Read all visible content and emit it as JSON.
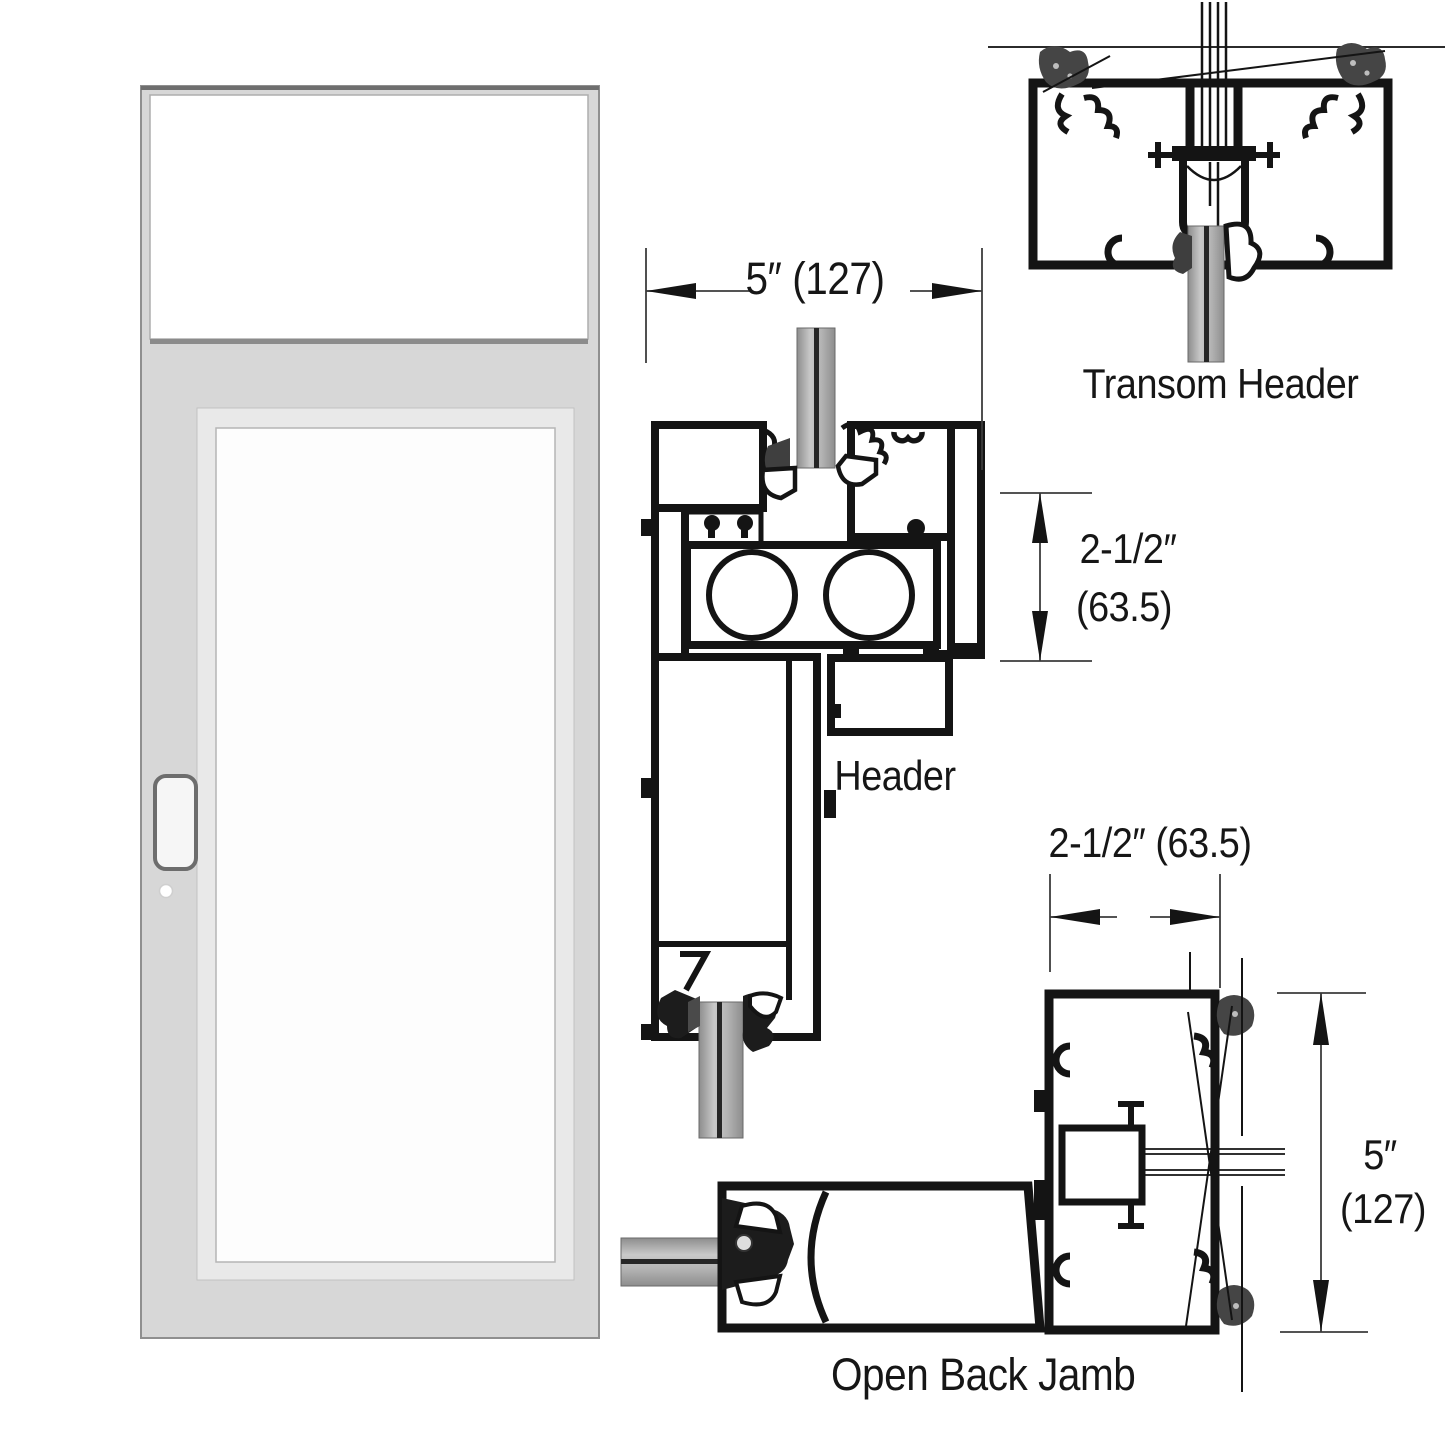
{
  "sections": {
    "transom_header": {
      "label": "Transom Header"
    },
    "header": {
      "label": "Header"
    },
    "open_back_jamb": {
      "label": "Open Back Jamb"
    }
  },
  "dimensions": {
    "header_width": "5″ (127)",
    "header_depth_top": "2-1/2″",
    "header_depth_bottom": "(63.5)",
    "jamb_width": "2-1/2″ (63.5)",
    "jamb_height_top": "5″",
    "jamb_height_bottom": "(127)"
  },
  "colors": {
    "ink": "#141414",
    "dim_line": "#3c3c3c",
    "door_frame": "#d7d7d7",
    "door_inner_band": "#e9e9e9",
    "door_glass": "#fdfdfd"
  }
}
